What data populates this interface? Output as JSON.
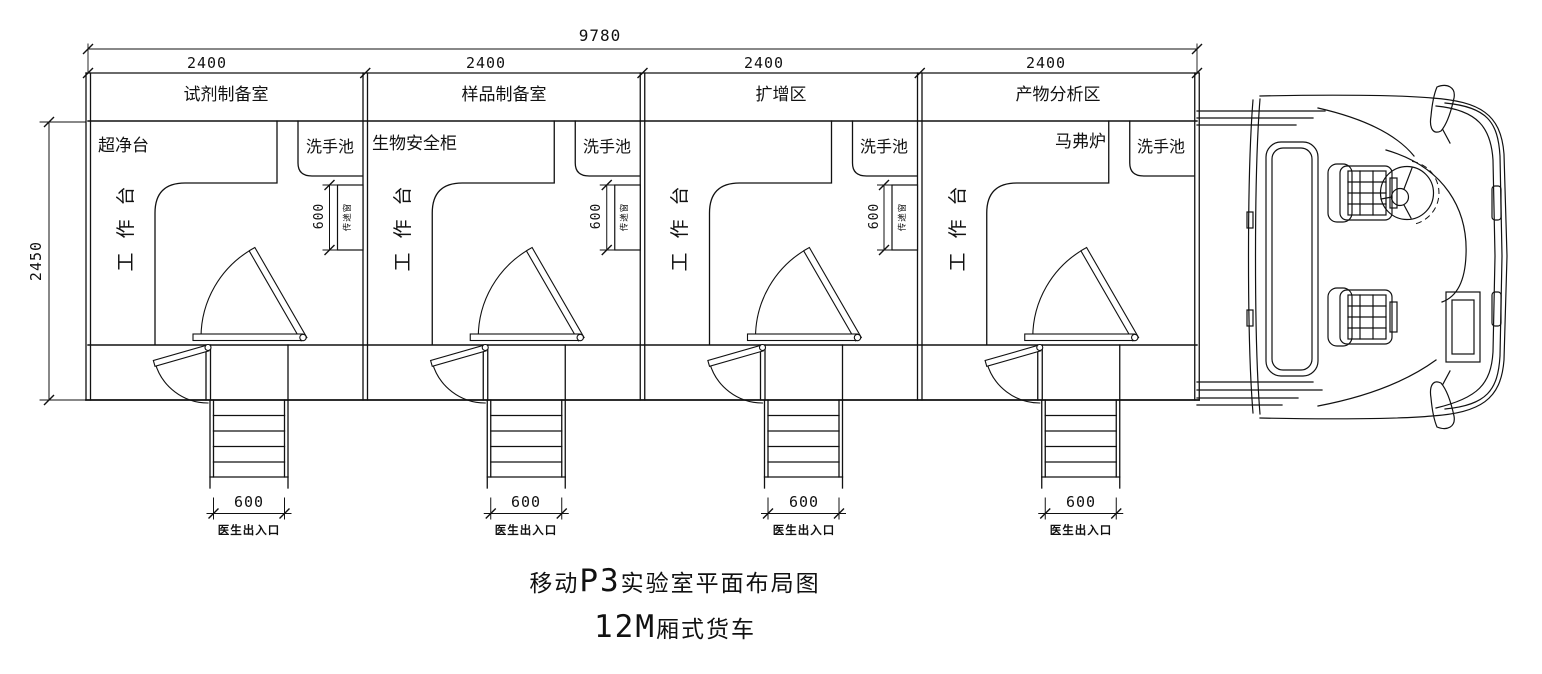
{
  "drawing": {
    "dims": {
      "overall_width": "9780",
      "overall_depth": "2450",
      "room_width": "2400",
      "pass_window_width": "600",
      "exit_width": "600"
    },
    "labels": {
      "bench": "工作台",
      "sink": "洗手池",
      "pass_window": "传递窗",
      "exit": "医生出入口"
    },
    "rooms": [
      {
        "name": "试剂制备室",
        "equipment": "超净台"
      },
      {
        "name": "样品制备室",
        "equipment": "生物安全柜"
      },
      {
        "name": "扩增区",
        "equipment": ""
      },
      {
        "name": "产物分析区",
        "equipment": "马弗炉"
      }
    ],
    "title": {
      "line1_prefix": "移动",
      "line1_code": "P3",
      "line1_suffix": "实验室平面布局图",
      "line2_code": "12M",
      "line2_suffix": "厢式货车"
    },
    "colors": {
      "line": "#111111",
      "background": "#ffffff"
    }
  }
}
